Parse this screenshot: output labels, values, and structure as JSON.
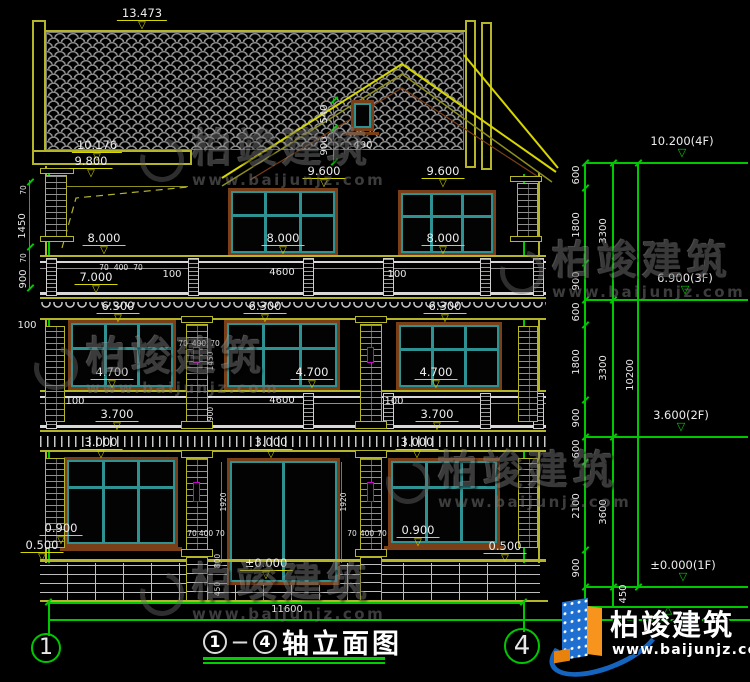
{
  "page": {
    "background": "#000000"
  },
  "title": {
    "num1": "1",
    "dash": "—",
    "num2": "4",
    "text": "轴立面图"
  },
  "axis": {
    "left": "1",
    "right": "4"
  },
  "logo": {
    "brand": "柏竣建筑",
    "url": "www.baijunjz.com"
  },
  "watermark": {
    "brand": "柏竣建筑",
    "url": "www.baijunjz.com",
    "positions": [
      {
        "x": 140,
        "y": 128
      },
      {
        "x": 500,
        "y": 240
      },
      {
        "x": 34,
        "y": 336
      },
      {
        "x": 386,
        "y": 450
      },
      {
        "x": 140,
        "y": 562
      }
    ]
  },
  "colors": {
    "cad_yellow": "#b5b52a",
    "cad_green": "#00c800",
    "window_teal": "#2f9292",
    "frame_brown": "#7a3f16",
    "vent_magenta": "#cc00cc",
    "text_white": "#e8e8e8",
    "logo_blue": "#1e6fd0",
    "logo_orange": "#f7941d"
  },
  "annotations": {
    "levels": [
      {
        "t": "13.473",
        "x": 142,
        "y": 7
      },
      {
        "t": "10.176",
        "x": 97,
        "y": 139
      },
      {
        "t": "9.800",
        "x": 91,
        "y": 155
      },
      {
        "t": "9.600",
        "x": 324,
        "y": 165
      },
      {
        "t": "9.600",
        "x": 443,
        "y": 165
      },
      {
        "t": "8.000",
        "x": 104,
        "y": 232
      },
      {
        "t": "8.000",
        "x": 283,
        "y": 232
      },
      {
        "t": "8.000",
        "x": 443,
        "y": 232
      },
      {
        "t": "7.000",
        "x": 96,
        "y": 271
      },
      {
        "t": "6.300",
        "x": 118,
        "y": 300
      },
      {
        "t": "6.300",
        "x": 265,
        "y": 300
      },
      {
        "t": "6.300",
        "x": 445,
        "y": 300
      },
      {
        "t": "4.700",
        "x": 112,
        "y": 366
      },
      {
        "t": "4.700",
        "x": 312,
        "y": 366
      },
      {
        "t": "4.700",
        "x": 436,
        "y": 366
      },
      {
        "t": "3.700",
        "x": 117,
        "y": 408
      },
      {
        "t": "3.700",
        "x": 437,
        "y": 408
      },
      {
        "t": "3.000",
        "x": 101,
        "y": 436
      },
      {
        "t": "3.000",
        "x": 271,
        "y": 436
      },
      {
        "t": "3.000",
        "x": 417,
        "y": 436
      },
      {
        "t": "0.900",
        "x": 61,
        "y": 522
      },
      {
        "t": "0.900",
        "x": 418,
        "y": 524
      },
      {
        "t": "0.500",
        "x": 42,
        "y": 539
      },
      {
        "t": "0.500",
        "x": 505,
        "y": 540
      },
      {
        "t": "±0.000",
        "x": 266,
        "y": 557
      }
    ],
    "right_levels": [
      {
        "t": "10.200(4F)",
        "x": 682,
        "ly": 163
      },
      {
        "t": "6.900(3F)",
        "x": 685,
        "ly": 300
      },
      {
        "t": "3.600(2F)",
        "x": 681,
        "ly": 437
      },
      {
        "t": "±0.000(1F)",
        "x": 683,
        "ly": 587
      },
      {
        "t": "",
        "x": 668,
        "ly": 607,
        "up": true
      }
    ],
    "dims": [
      {
        "t": "490",
        "x": 363,
        "y": 141
      },
      {
        "t": "100",
        "x": 172,
        "y": 270
      },
      {
        "t": "4600",
        "x": 282,
        "y": 268
      },
      {
        "t": "100",
        "x": 397,
        "y": 270
      },
      {
        "t": "70",
        "x": 104,
        "y": 263,
        "s": 1
      },
      {
        "t": "400",
        "x": 121,
        "y": 263,
        "s": 1
      },
      {
        "t": "70",
        "x": 138,
        "y": 263,
        "s": 1
      },
      {
        "t": "100",
        "x": 27,
        "y": 321
      },
      {
        "t": "100",
        "x": 75,
        "y": 397
      },
      {
        "t": "4600",
        "x": 282,
        "y": 396
      },
      {
        "t": "100",
        "x": 394,
        "y": 397
      },
      {
        "t": "70",
        "x": 183,
        "y": 339,
        "s": 1
      },
      {
        "t": "400",
        "x": 199,
        "y": 339,
        "s": 1
      },
      {
        "t": "70",
        "x": 215,
        "y": 339,
        "s": 1
      },
      {
        "t": "70",
        "x": 192,
        "y": 529,
        "s": 1
      },
      {
        "t": "400",
        "x": 206,
        "y": 529,
        "s": 1
      },
      {
        "t": "70",
        "x": 220,
        "y": 529,
        "s": 1
      },
      {
        "t": "70",
        "x": 352,
        "y": 529,
        "s": 1
      },
      {
        "t": "400",
        "x": 367,
        "y": 529,
        "s": 1
      },
      {
        "t": "70",
        "x": 382,
        "y": 529,
        "s": 1
      },
      {
        "t": "11600",
        "x": 287,
        "y": 605
      }
    ],
    "dims_vertical": [
      {
        "t": "540",
        "x": 325,
        "y": 114
      },
      {
        "t": "900",
        "x": 325,
        "y": 146
      },
      {
        "t": "70",
        "x": 24,
        "y": 190,
        "s": 1
      },
      {
        "t": "1450",
        "x": 23,
        "y": 226
      },
      {
        "t": "70",
        "x": 24,
        "y": 258,
        "s": 1
      },
      {
        "t": "900",
        "x": 24,
        "y": 279
      },
      {
        "t": "1450",
        "x": 211,
        "y": 361,
        "s": 1
      },
      {
        "t": "900",
        "x": 211,
        "y": 414,
        "s": 1
      },
      {
        "t": "1920",
        "x": 224,
        "y": 502,
        "s": 1
      },
      {
        "t": "1920",
        "x": 344,
        "y": 502,
        "s": 1
      },
      {
        "t": "800",
        "x": 218,
        "y": 561,
        "s": 1
      },
      {
        "t": "450",
        "x": 218,
        "y": 589,
        "s": 1
      },
      {
        "t": "600",
        "x": 577,
        "y": 175
      },
      {
        "t": "1800",
        "x": 577,
        "y": 225
      },
      {
        "t": "900",
        "x": 577,
        "y": 281
      },
      {
        "t": "600",
        "x": 577,
        "y": 312
      },
      {
        "t": "1800",
        "x": 577,
        "y": 362
      },
      {
        "t": "900",
        "x": 577,
        "y": 418
      },
      {
        "t": "600",
        "x": 577,
        "y": 449
      },
      {
        "t": "2100",
        "x": 577,
        "y": 506
      },
      {
        "t": "900",
        "x": 577,
        "y": 568
      },
      {
        "t": "3300",
        "x": 604,
        "y": 231
      },
      {
        "t": "3300",
        "x": 604,
        "y": 368
      },
      {
        "t": "3600",
        "x": 604,
        "y": 512
      },
      {
        "t": "10200",
        "x": 631,
        "y": 375
      },
      {
        "t": "450",
        "x": 624,
        "y": 594
      }
    ]
  }
}
